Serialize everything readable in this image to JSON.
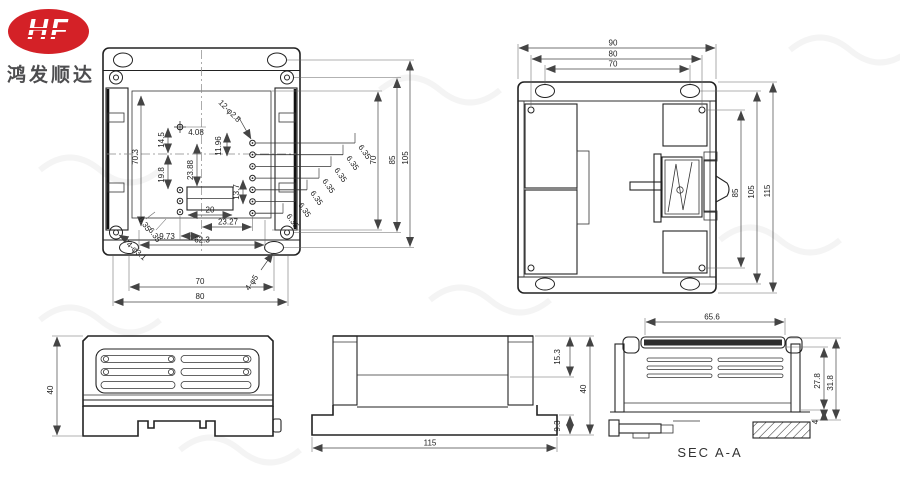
{
  "logo": {
    "brand": "HF",
    "company": "鸿发顺达"
  },
  "plan": {
    "callout_holes": "12-φ2.8",
    "callout_corner": "4-φ3.1",
    "callout_slot": "4-φ5",
    "dim_105": "105",
    "dim_85": "85",
    "dim_70r": "70",
    "dim_703": "70.3",
    "dim_145": "14.5",
    "dim_408": "4.08",
    "dim_198": "19.8",
    "dim_2388": "23.88",
    "dim_1196": "11.96",
    "dim_137": "13.7",
    "dim_20": "20",
    "dim_2327": "23.27",
    "dim_973": "9.73",
    "dim_623": "62.3",
    "dim_70b": "70",
    "dim_80": "80",
    "pitch": [
      "6.35",
      "6.35",
      "6.35",
      "6.35",
      "6.35",
      "6.35",
      "6.35",
      "6.35",
      "6.35"
    ]
  },
  "bottom": {
    "dim_90": "90",
    "dim_80": "80",
    "dim_70": "70",
    "dim_85": "85",
    "dim_105": "105",
    "dim_115": "115"
  },
  "front": {
    "dim_40": "40"
  },
  "end": {
    "dim_153": "15.3",
    "dim_40": "40",
    "dim_93": "9.3",
    "dim_115": "115"
  },
  "section": {
    "dim_656": "65.6",
    "dim_278": "27.8",
    "dim_318": "31.8",
    "dim_4": "4",
    "label": "SEC A-A"
  }
}
